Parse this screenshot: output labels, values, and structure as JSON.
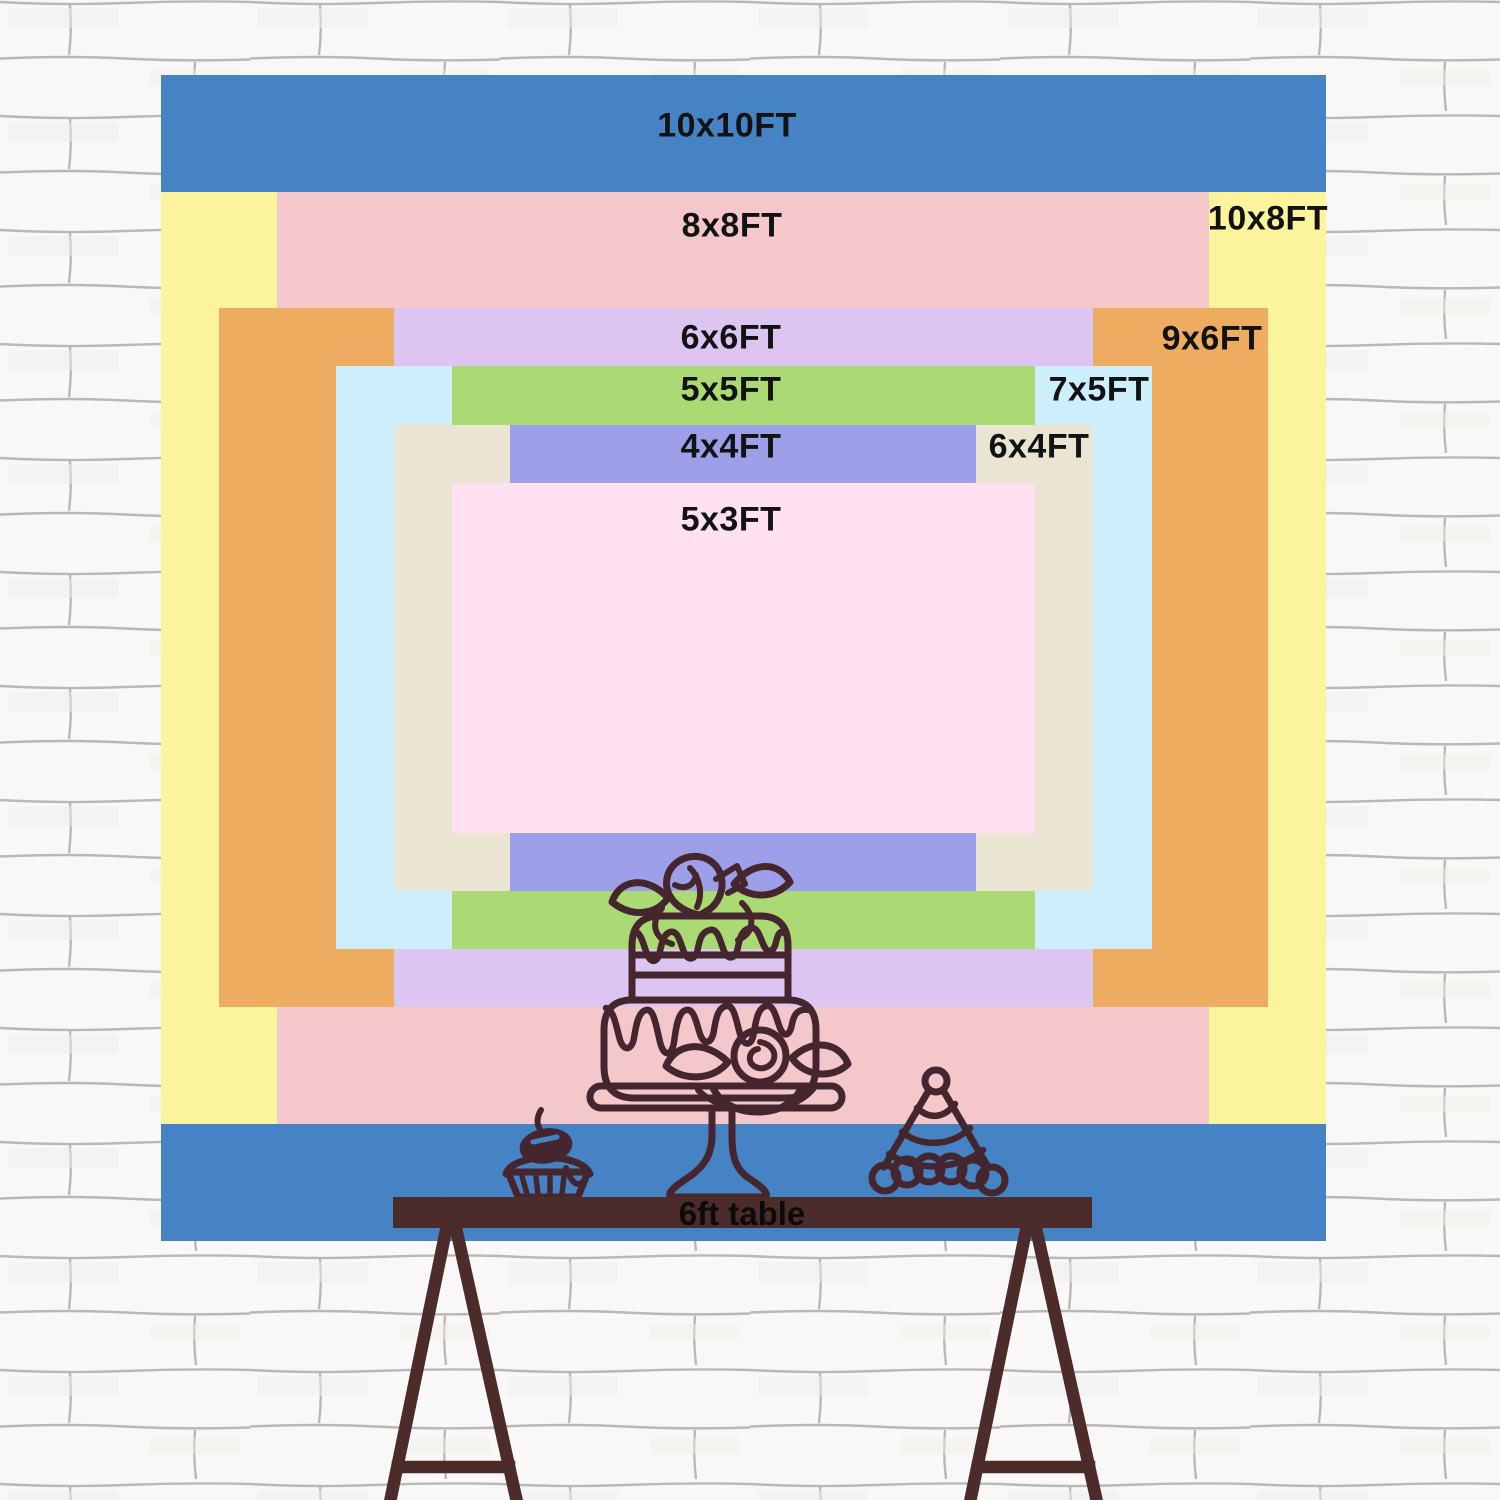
{
  "title": "Backdrop size comparison chart",
  "sizes": [
    {
      "id": "10x10",
      "label": "10x10FT",
      "width_ft": 10,
      "height_ft": 10,
      "color": "#4583c4"
    },
    {
      "id": "10x8",
      "label": "10x8FT",
      "width_ft": 10,
      "height_ft": 8,
      "color": "#fbf49d"
    },
    {
      "id": "8x8",
      "label": "8x8FT",
      "width_ft": 8,
      "height_ft": 8,
      "color": "#f4c8cb"
    },
    {
      "id": "9x6",
      "label": "9x6FT",
      "width_ft": 9,
      "height_ft": 6,
      "color": "#edac60"
    },
    {
      "id": "6x6",
      "label": "6x6FT",
      "width_ft": 6,
      "height_ft": 6,
      "color": "#dcc5f1"
    },
    {
      "id": "7x5",
      "label": "7x5FT",
      "width_ft": 7,
      "height_ft": 5,
      "color": "#cdeffb"
    },
    {
      "id": "5x5",
      "label": "5x5FT",
      "width_ft": 5,
      "height_ft": 5,
      "color": "#abd973"
    },
    {
      "id": "6x4",
      "label": "6x4FT",
      "width_ft": 6,
      "height_ft": 4,
      "color": "#eae4d2"
    },
    {
      "id": "4x4",
      "label": "4x4FT",
      "width_ft": 4,
      "height_ft": 4,
      "color": "#9d9fe8"
    },
    {
      "id": "5x3",
      "label": "5x3FT",
      "width_ft": 5,
      "height_ft": 3,
      "color": "#fee0f0"
    }
  ],
  "table": {
    "label": "6ft table",
    "color": "#4c2b2b"
  },
  "illustrations": [
    "tiered-cake-on-stand",
    "cupcake-with-cherry",
    "party-hat"
  ],
  "line_art_color": "#46262e",
  "wall": {
    "style": "white sketched brick",
    "base_color": "#f9f8f6",
    "mortar_color": "#8d8d8d"
  }
}
